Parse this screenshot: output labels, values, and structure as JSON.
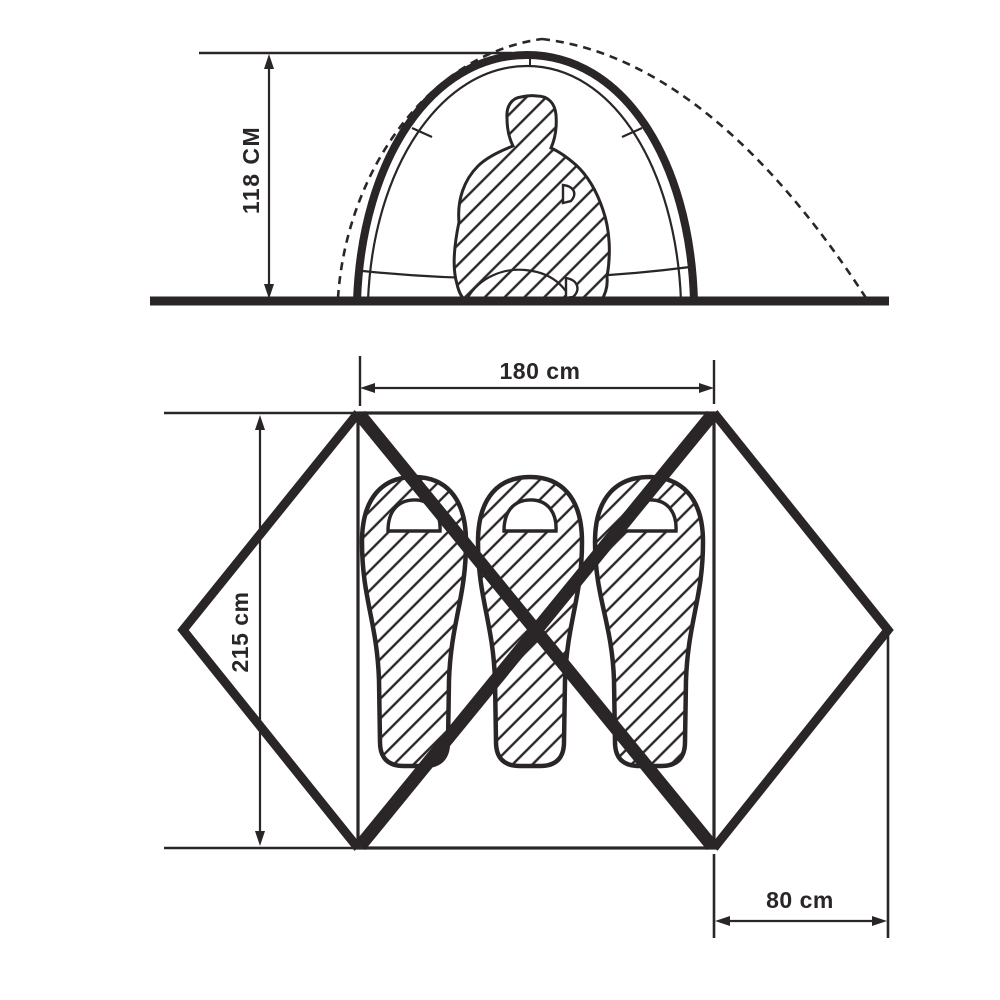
{
  "diagram": {
    "type": "tent-specification-drawing",
    "colors": {
      "ink": "#2a2627",
      "background": "#ffffff"
    },
    "side_view": {
      "description": "side elevation of dome tent with seated person silhouette",
      "height_label": "118 CM"
    },
    "floor_plan": {
      "description": "top view of tent floor with three sleeping bags, crossed poles and two vestibules",
      "width_label": "180 cm",
      "depth_label": "215 cm",
      "vestibule_label": "80 cm",
      "sleeping_bags_count": 3
    }
  }
}
